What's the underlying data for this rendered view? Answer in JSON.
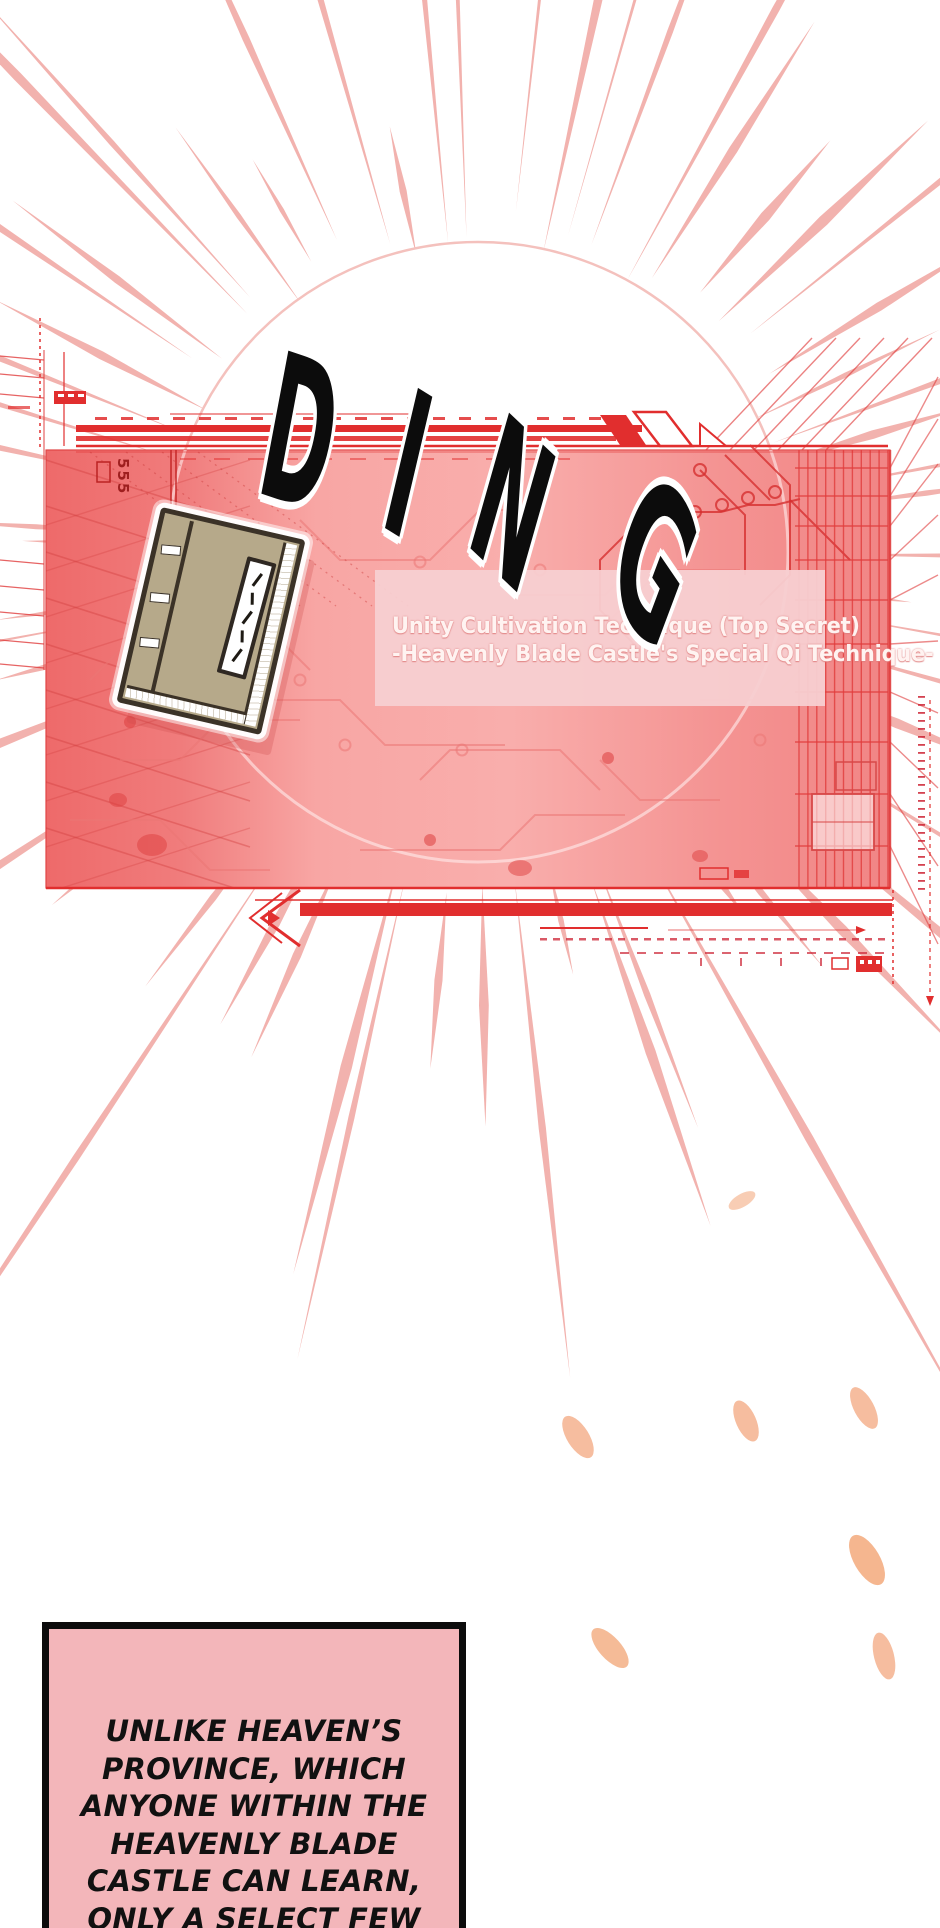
{
  "sfx": {
    "ding": "DING"
  },
  "system_panel": {
    "title_line1": "Unity Cultivation Technique (Top Secret)",
    "title_line2": "-Heavenly Blade Castle's Special Qi Technique-",
    "hud_marker": "555"
  },
  "narration": {
    "text": "UNLIKE HEAVEN’S\nPROVINCE, WHICH\nANYONE WITHIN THE\nHEAVENLY BLADE\nCASTLE CAN LEARN,\nONLY A SELECT FEW"
  },
  "colors": {
    "panel_pink": "#f28585",
    "hud_red": "#e12e2e",
    "ray_salmon": "#f2b2ae",
    "petal_peach": "#f6bd9f",
    "narration_pink": "#f3b6ba",
    "book_tan": "#b6a98a",
    "title_box_pink": "#f7cfd1",
    "title_text": "#fff3f1"
  }
}
